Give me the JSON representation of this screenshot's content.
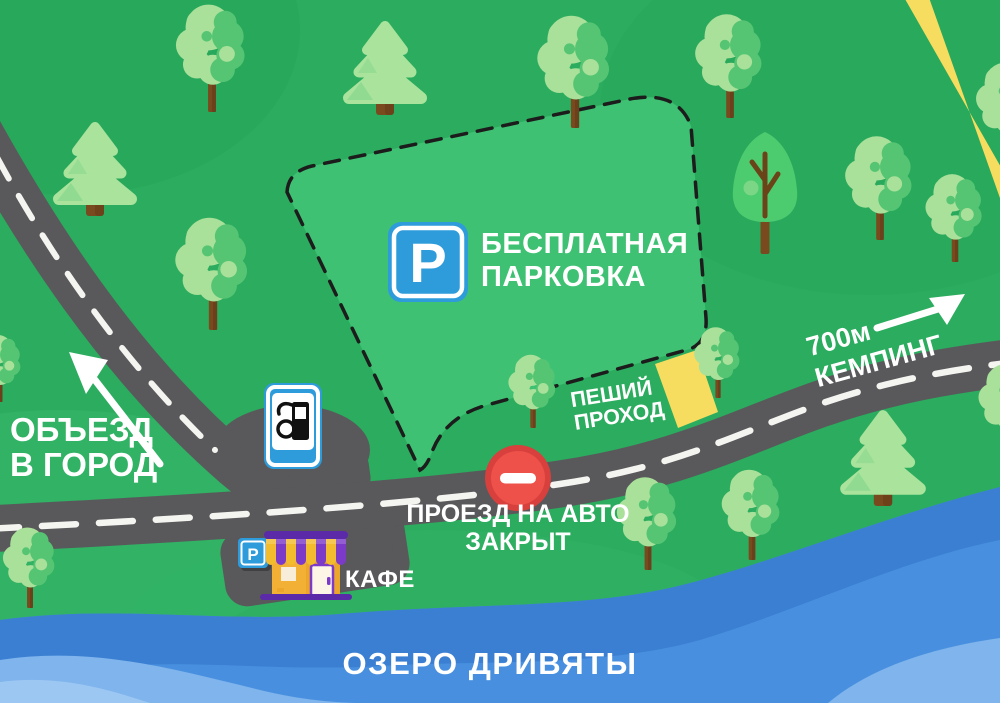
{
  "map": {
    "title": "Иллюстрированная карта проезда",
    "signs": {
      "free_parking": {
        "icon_letter": "P",
        "line1": "БЕСПЛАТНАЯ",
        "line2": "ПАРКОВКА"
      },
      "detour": {
        "line1": "ОБЪЕЗД",
        "line2": "В ГОРОД"
      },
      "camping": {
        "line1": "700м",
        "line2": "КЕМПИНГ"
      },
      "pedestrian": {
        "line1": "ПЕШИЙ",
        "line2": "ПРОХОД"
      },
      "road_closed": {
        "line1": "ПРОЕЗД НА АВТО",
        "line2": "ЗАКРЫТ"
      },
      "cafe": {
        "label": "КАФЕ",
        "parking_letter": "P"
      },
      "lake": {
        "label": "ОЗЕРО ДРИВЯТЫ"
      }
    },
    "icons": [
      "parking-icon",
      "fuel-pump-icon",
      "no-entry-icon"
    ],
    "colors": {
      "background": "#2BAC5E",
      "terrain_light": "#35B569",
      "terrain_dark": "#26A458",
      "parking_zone": "#3FC173",
      "parking_border": "#1C1C1C",
      "road": "#59595B",
      "road_marking": "#F4F4F1",
      "footpath": "#F6DD5F",
      "water": "#4890DF",
      "water_dark": "#3B7FD2",
      "water_light": "#7FB4EC",
      "water_lightest": "#9CC7F3",
      "sign_blue": "#2E9BDB",
      "sign_white": "#FFFFFF",
      "no_entry_ring": "#D8403D",
      "no_entry_fill": "#EE5149",
      "tree_light": "#A9E09A",
      "tree_dark": "#55C573",
      "fir": "#A9E39C",
      "fir_dark": "#7ED389",
      "poplar": "#4DCB6F",
      "trunk": "#7A4A1F",
      "trunk_dark": "#5F3918",
      "branch": "#6B4318",
      "cafe_wall": "#F2B035",
      "cafe_wall_dark": "#ECA72B",
      "cafe_purple": "#7B3BC8",
      "cafe_awning_yellow": "#F3BC2F",
      "cafe_base": "#5B2AA8",
      "cafe_door": "#FDF5E6",
      "cafe_window": "#F7EDD8",
      "label": "#FFFFFF"
    }
  }
}
